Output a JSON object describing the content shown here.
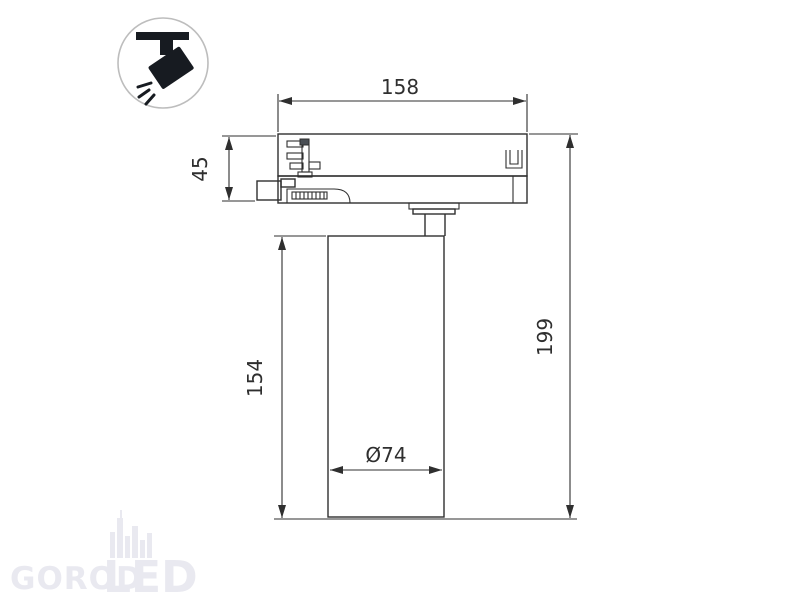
{
  "page": {
    "background_color": "#ffffff",
    "line_color": "#2f2f2f",
    "watermark_color": "#e9e9f0",
    "icon_glyph_color": "#171b21",
    "icon_circle_border_color": "#bdbdbd"
  },
  "icons": {
    "track_spotlight_badge": "ceiling-track-spotlight-icon"
  },
  "drawing": {
    "type": "technical-dimension-drawing",
    "subject": "track-mounted cylindrical LED spotlight, side view",
    "dimensions": {
      "track_adapter_width": "158",
      "track_adapter_height": "45",
      "lamp_body_height": "154",
      "total_height": "199",
      "body_diameter": "Ø74"
    }
  },
  "watermark": {
    "text_gorod": "GOROD",
    "text_led": "LED"
  }
}
